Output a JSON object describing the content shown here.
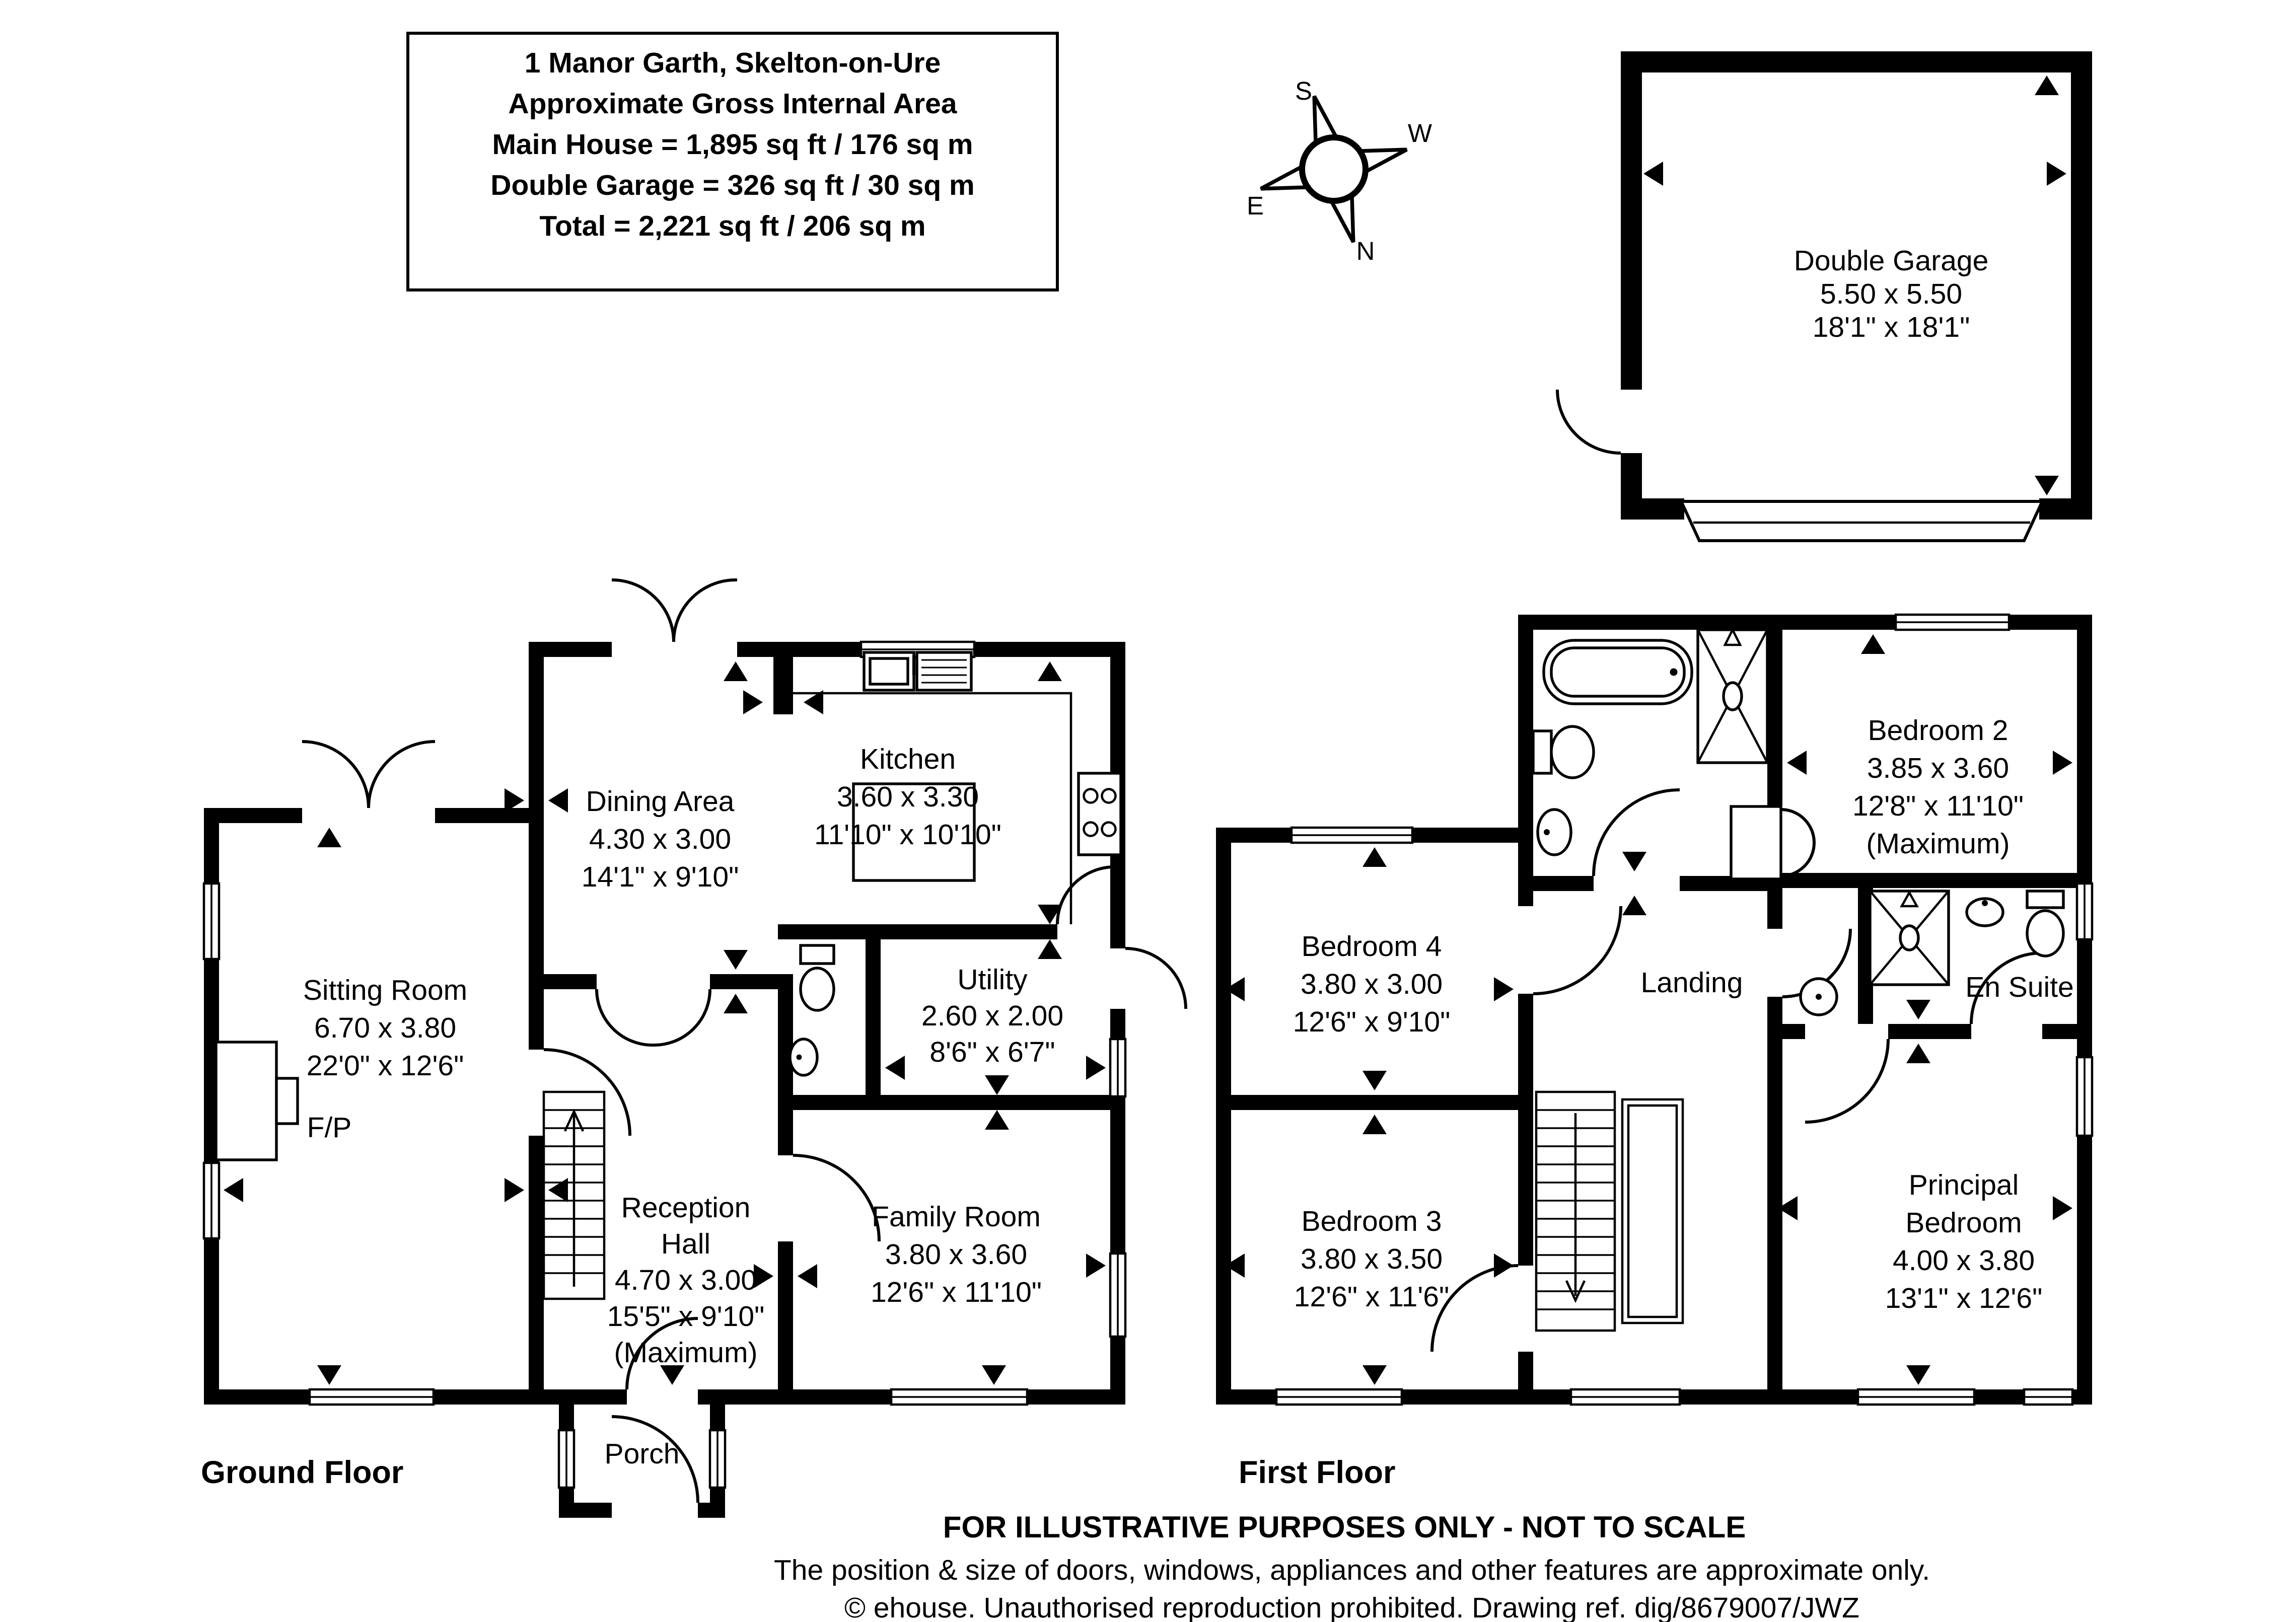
{
  "title_block": {
    "line1": "1 Manor Garth, Skelton-on-Ure",
    "line2": "Approximate Gross Internal Area",
    "line3": "Main House = 1,895 sq ft / 176 sq m",
    "line4": "Double Garage = 326 sq ft / 30 sq m",
    "line5": "Total = 2,221 sq ft / 206 sq m"
  },
  "compass": {
    "n": "N",
    "s": "S",
    "e": "E",
    "w": "W"
  },
  "garage": {
    "name": "Double Garage",
    "metric": "5.50 x 5.50",
    "imperial": "18'1\" x 18'1\""
  },
  "ground_floor": {
    "label": "Ground Floor",
    "sitting_room": {
      "name": "Sitting Room",
      "metric": "6.70 x 3.80",
      "imperial": "22'0\" x 12'6\""
    },
    "dining_area": {
      "name": "Dining Area",
      "metric": "4.30 x 3.00",
      "imperial": "14'1\" x 9'10\""
    },
    "kitchen": {
      "name": "Kitchen",
      "metric": "3.60 x 3.30",
      "imperial": "11'10\" x 10'10\""
    },
    "utility": {
      "name": "Utility",
      "metric": "2.60 x 2.00",
      "imperial": "8'6\" x 6'7\""
    },
    "reception_hall": {
      "name_line1": "Reception",
      "name_line2": "Hall",
      "metric": "4.70 x 3.00",
      "imperial": "15'5\" x 9'10\"",
      "note": "(Maximum)"
    },
    "family_room": {
      "name": "Family Room",
      "metric": "3.80 x 3.60",
      "imperial": "12'6\" x 11'10\""
    },
    "porch": "Porch",
    "fireplace": "F/P"
  },
  "first_floor": {
    "label": "First Floor",
    "bedroom_2": {
      "name": "Bedroom 2",
      "metric": "3.85 x 3.60",
      "imperial": "12'8\" x 11'10\"",
      "note": "(Maximum)"
    },
    "bedroom_4": {
      "name": "Bedroom 4",
      "metric": "3.80 x 3.00",
      "imperial": "12'6\" x 9'10\""
    },
    "bedroom_3": {
      "name": "Bedroom 3",
      "metric": "3.80 x 3.50",
      "imperial": "12'6\" x 11'6\""
    },
    "principal_bedroom": {
      "name_line1": "Principal",
      "name_line2": "Bedroom",
      "metric": "4.00 x 3.80",
      "imperial": "13'1\" x 12'6\""
    },
    "landing": "Landing",
    "en_suite": "En Suite"
  },
  "footer": {
    "line1": "FOR ILLUSTRATIVE PURPOSES ONLY - NOT TO SCALE",
    "line2": "The position & size of doors, windows, appliances and other features are approximate only.",
    "line3": "© ehouse. Unauthorised reproduction prohibited. Drawing ref. dig/8679007/JWZ"
  }
}
